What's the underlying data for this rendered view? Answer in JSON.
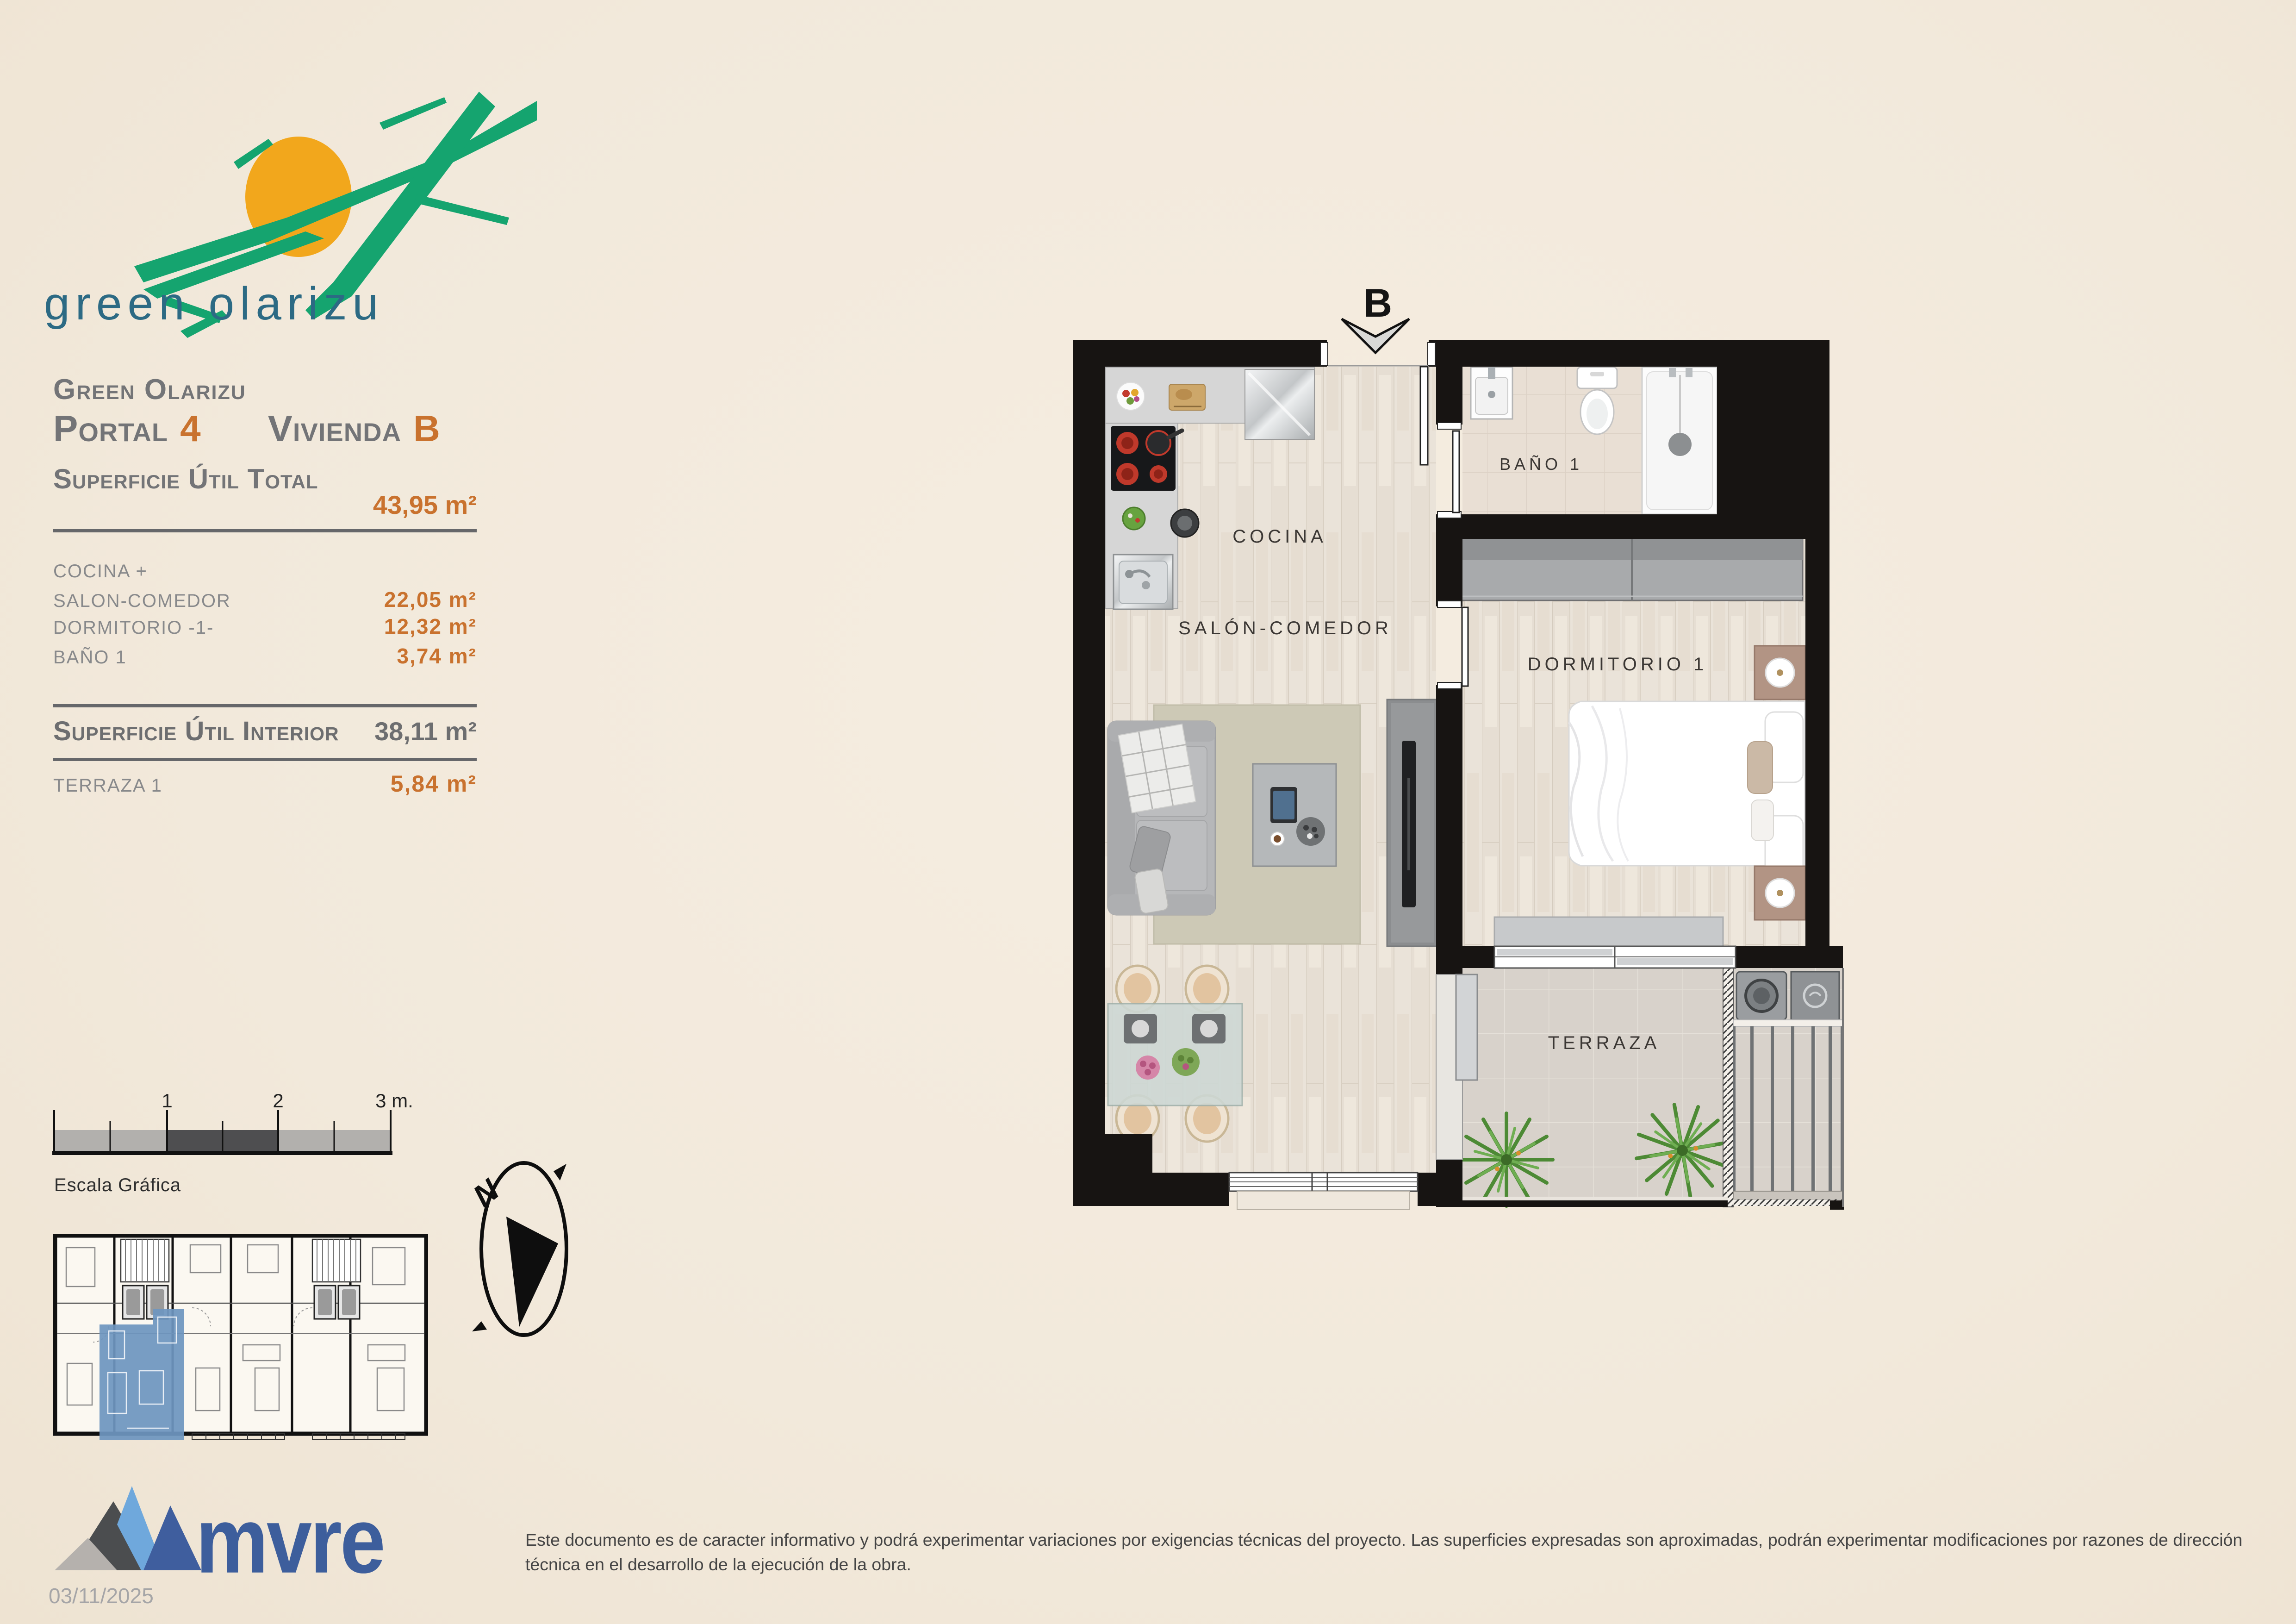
{
  "logo": {
    "title": "green olarizu"
  },
  "panel": {
    "project": "Green Olarizu",
    "portal_label": "Portal",
    "portal_value": "4",
    "vivienda_label": "Vivienda",
    "vivienda_value": "B",
    "total_label": "Superficie Útil Total",
    "total_value": "43,95 m²",
    "rows": [
      {
        "label": "COCINA +",
        "value": ""
      },
      {
        "label": "SALON-COMEDOR",
        "value": "22,05 m²"
      },
      {
        "label": "DORMITORIO -1-",
        "value": "12,32 m²"
      },
      {
        "label": "BAÑO 1",
        "value": "3,74 m²"
      }
    ],
    "interior_label": "Superficie Útil Interior",
    "interior_value": "38,11 m²",
    "terraza_label": "TERRAZA 1",
    "terraza_value": "5,84 m²"
  },
  "scalebar": {
    "title": "Escala Gráfica",
    "tick1": "1",
    "tick2": "2",
    "tick3": "3 m."
  },
  "compass": {
    "north": "N"
  },
  "plan": {
    "entrance_label": "B",
    "labels": {
      "cocina": "COCINA",
      "salon": "SALÓN-COMEDOR",
      "bano": "BAÑO 1",
      "dormitorio": "DORMITORIO 1",
      "terraza": "TERRAZA"
    }
  },
  "footer": {
    "brand": "mvre",
    "date": "03/11/2025",
    "disclaimer": "Este documento es de caracter informativo y podrá experimentar variaciones por exigencias técnicas del proyecto. Las superficies expresadas son aproximadas, podrán experimentar modificaciones por razones de dirección técnica en el desarrollo de la ejecución de la obra."
  },
  "colors": {
    "background": "#f2e9dc",
    "accent_orange": "#c9722e",
    "heading_gray": "#737477",
    "row_gray": "#88898b",
    "logo_green": "#15a46f",
    "logo_sun": "#f2a71c",
    "logo_text": "#2c6a84",
    "brand_blue": "#3d5e9c",
    "highlight_unit_blue": "#6e96bf",
    "wall_black": "#171412"
  }
}
